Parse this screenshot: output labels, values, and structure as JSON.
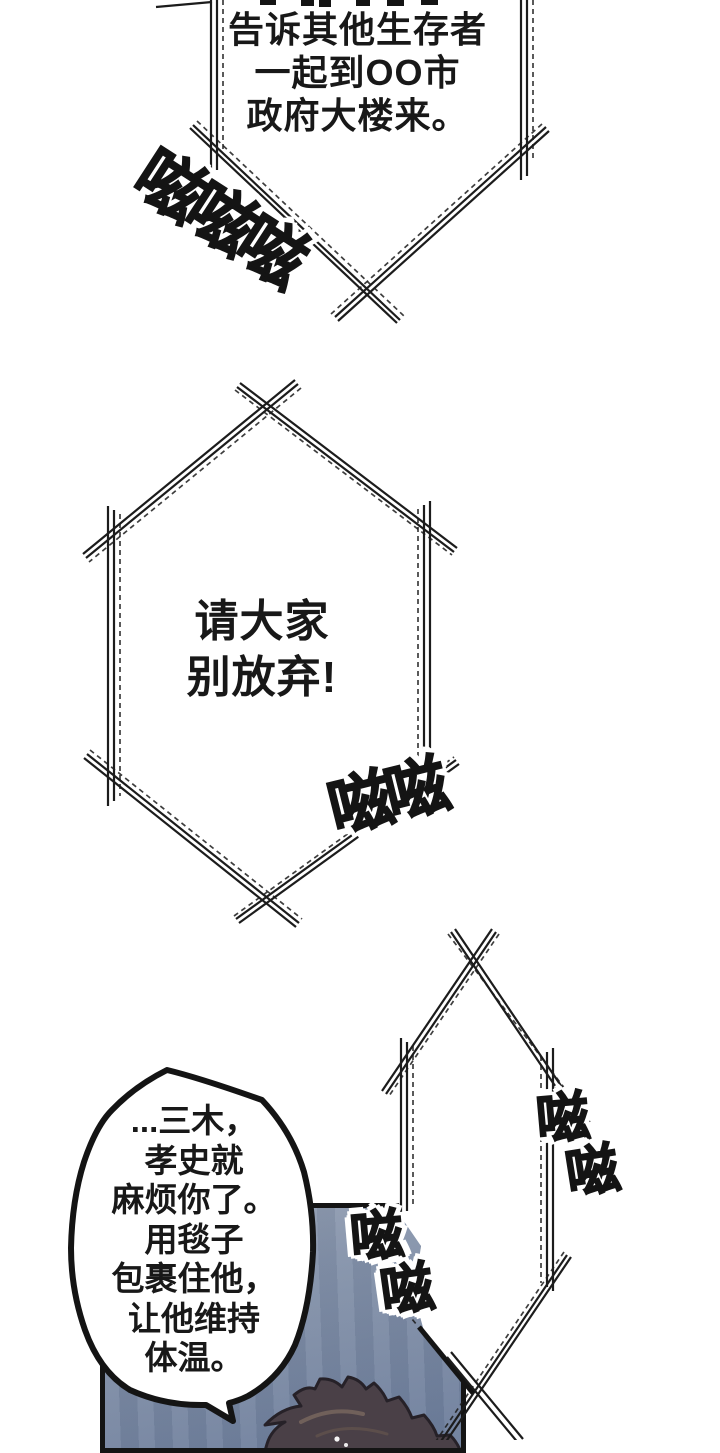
{
  "page": {
    "background": "#ffffff",
    "ink": "#1c1c1c",
    "sky_top": "#95a1b4",
    "sky_bottom": "#6c7d9b",
    "hair_fill": "#4a4047",
    "hair_outline": "#262128",
    "hair_highlight": "#70605a"
  },
  "bubbles": {
    "top_broadcast": {
      "lines": [
        "告诉其他生存者",
        "一起到OO市",
        "政府大楼来。"
      ]
    },
    "middle_broadcast": {
      "lines": [
        "请大家",
        "别放弃!"
      ]
    },
    "right_broadcast": {
      "lines": [
        "重复",
        "播",
        "报..."
      ]
    },
    "speech": {
      "lines": [
        "...三木，",
        "孝史就",
        "麻烦你了。",
        "用毯子",
        "包裹住他，",
        "让他维持",
        "体温。"
      ]
    }
  },
  "sfx": {
    "top": "嗞嗞嗞",
    "middle": "嗞嗞",
    "right_upper": "嗞",
    "right_lower": "嗞",
    "panel_upper": "嗞",
    "panel_lower": "嗞"
  }
}
